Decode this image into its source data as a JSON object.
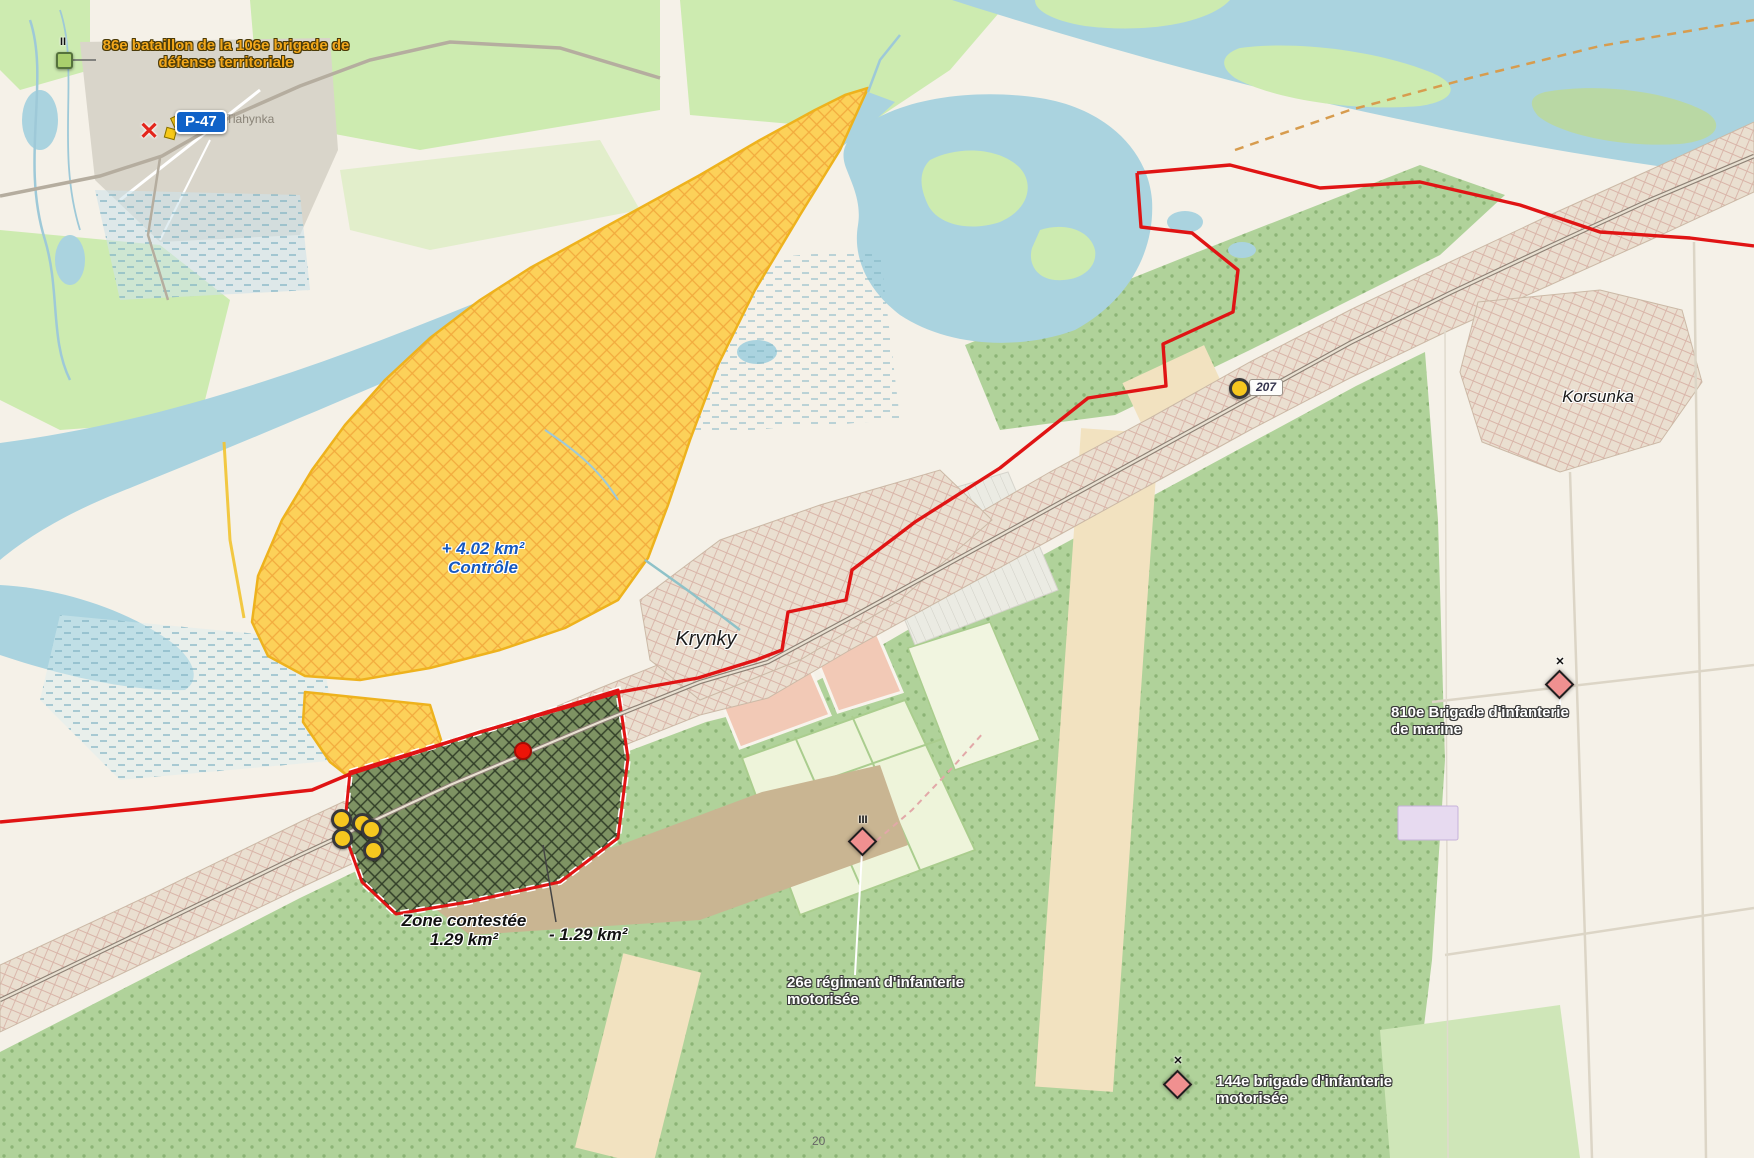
{
  "map": {
    "places": {
      "tiahynka": "Tiahynka",
      "krynky": "Krynky",
      "korsunka": "Korsunka",
      "parcel_number": "20"
    },
    "road_badges": {
      "p47": "P-47",
      "t207": "207"
    },
    "annotations": {
      "control": {
        "value": "+ 4.02 km²",
        "label": "Contrôle"
      },
      "contested": {
        "label": "Zone contestée",
        "value": "1.29 km²"
      },
      "loss": {
        "value": "- 1.29 km²"
      }
    },
    "units": {
      "u86": {
        "echelon": "II",
        "line1": "86e bataillon de la 106e brigade de",
        "line2": "défense territoriale"
      },
      "u26": {
        "echelon": "III",
        "line1": "26e régiment d'infanterie",
        "line2": "motorisée"
      },
      "u810": {
        "echelon": "✕",
        "line1": "810e Brigade d'infanterie",
        "line2": "de marine"
      },
      "u144": {
        "echelon": "✕",
        "line1": "144e brigade d'infanterie",
        "line2": "motorisée"
      }
    },
    "icons": {
      "front_x": "✕"
    },
    "colors": {
      "frontline": "#e01414",
      "control_zone": "#fcd159",
      "contested_zone": "#7e9363",
      "water": "#aad3df",
      "friendly_marker": "#a9cf6d",
      "enemy_marker": "#f09090",
      "control_text": "#1558c0",
      "friendly_label": "#f2a71b"
    }
  }
}
